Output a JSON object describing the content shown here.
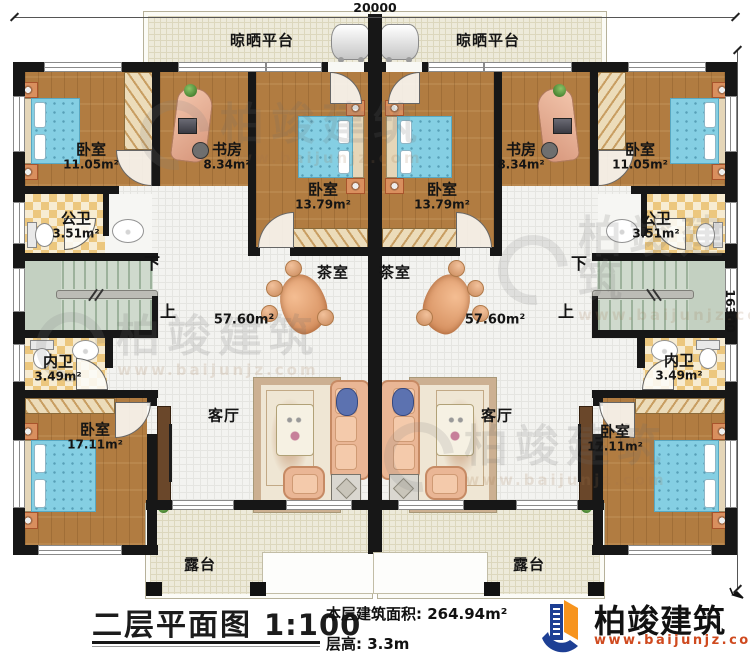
{
  "dimensions": {
    "top": "20000",
    "right": "16300"
  },
  "platform": {
    "label": "晾晒平台"
  },
  "rooms": {
    "bedroom_small": {
      "name": "卧室",
      "area": "11.05m²"
    },
    "study": {
      "name": "书房",
      "area": "8.34m²"
    },
    "bedroom_mid": {
      "name": "卧室",
      "area": "13.79m²"
    },
    "bath_public": {
      "name": "公卫",
      "area": "3.51m²"
    },
    "bath_inner": {
      "name": "内卫",
      "area": "3.49m²"
    },
    "bedroom_big": {
      "name": "卧室",
      "area": "17.11m²"
    },
    "tea": {
      "name": "茶室"
    },
    "living": {
      "name": "客厅"
    },
    "terrace": {
      "name": "露台"
    },
    "hall_area": "57.60m²"
  },
  "stairs": {
    "down": "下",
    "up": "上"
  },
  "title": {
    "main": "二层平面图",
    "scale": "1:100",
    "area": "本层建筑面积: 264.94m²",
    "floor_height": "层高: 3.3m"
  },
  "brand": {
    "name": "柏竣建筑",
    "url": "www.baijunjz.com"
  },
  "watermark": {
    "name": "柏竣建筑",
    "url": "www.baijunjz.com"
  }
}
